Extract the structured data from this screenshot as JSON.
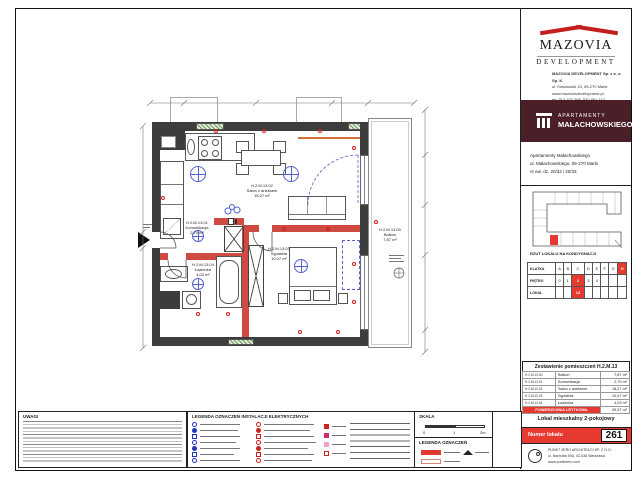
{
  "developer": {
    "logo_line1": "MAZOVIA",
    "logo_line2": "DEVELOPMENT",
    "address_lines": [
      "MAZOVIA DEVELOPMENT Sp. z o. o. Sp. K.",
      "ul. Kościuszki 43, 05-270 Marki",
      "www.mazoviadevelopment.pl",
      "tel: 512 107 399, 532 851 110"
    ]
  },
  "brand": {
    "line1": "APARTAMENTY",
    "line2": "MAŁACHOWSKIEGO"
  },
  "project": {
    "lines": [
      "Apartamenty Małachowskiego",
      "ul. Małachowskiego, 05-270 Marki",
      "nr ew. dz. 20/32 i 20/33"
    ]
  },
  "keyplan": {
    "caption": "RZUT LOKALU NA KONDYGNACJI"
  },
  "locator": {
    "klatka_label": "KLATKA",
    "klatka_cells": [
      "A",
      "B",
      "C",
      "D",
      "E",
      "F",
      "G",
      "H"
    ],
    "klatka_selected": "H",
    "pietro_label": "PIĘTRO",
    "pietro_cells": [
      "0",
      "1",
      "2",
      "3",
      "4",
      "",
      "",
      ""
    ],
    "pietro_selected": "2",
    "lokal_label": "LOKAL",
    "lokal_cells": [
      "",
      "",
      "13",
      "",
      "",
      "",
      "",
      ""
    ],
    "lokal_selected": "13"
  },
  "schedule": {
    "title": "Zestawienie pomieszczeń H.2.M.13",
    "rows": [
      {
        "code": "H.2.M.13.00",
        "name": "Balkon",
        "area": "7,87 m²"
      },
      {
        "code": "H.2.M.13.01",
        "name": "Komunikacja",
        "area": "2,70 m²"
      },
      {
        "code": "H.2.M.13.02",
        "name": "Salon z aneksem",
        "area": "18,27 m²"
      },
      {
        "code": "H.2.M.13.03",
        "name": "Sypialnia",
        "area": "10,07 m²"
      },
      {
        "code": "H.2.M.13.04",
        "name": "Łazienka",
        "area": "4,03 m²"
      }
    ],
    "total_label": "POWIERZCHNIA UŻYTKOWA",
    "total_area": "35,07 m²"
  },
  "unit": {
    "type": "Lokal mieszkalny 2-pokojowy",
    "number_label": "Numer lokalu",
    "number": "261"
  },
  "architect": {
    "lines": [
      "PUNKT ZERO ARCHITEKCI SP. Z O.O.",
      "ul. Narbutta 59A, 02-536 Warszawa",
      "www.punktzero.com"
    ]
  },
  "notes": {
    "title": "UWAGI"
  },
  "legend_electric": {
    "title": "LEGENDA OZNACZEŃ INSTALACJI ELEKTRYCZNYCH"
  },
  "scale": {
    "title": "SKALA",
    "ticks": [
      "0",
      "1",
      "2m"
    ]
  },
  "legend_general": {
    "title": "LEGENDA OZNACZEŃ"
  },
  "colors": {
    "accent_red": "#e6392f",
    "brand_maroon": "#4a1f28",
    "roof_red": "#c41e1e",
    "wall_dark": "#3d3d3d",
    "partition_red": "#cf4a41"
  }
}
